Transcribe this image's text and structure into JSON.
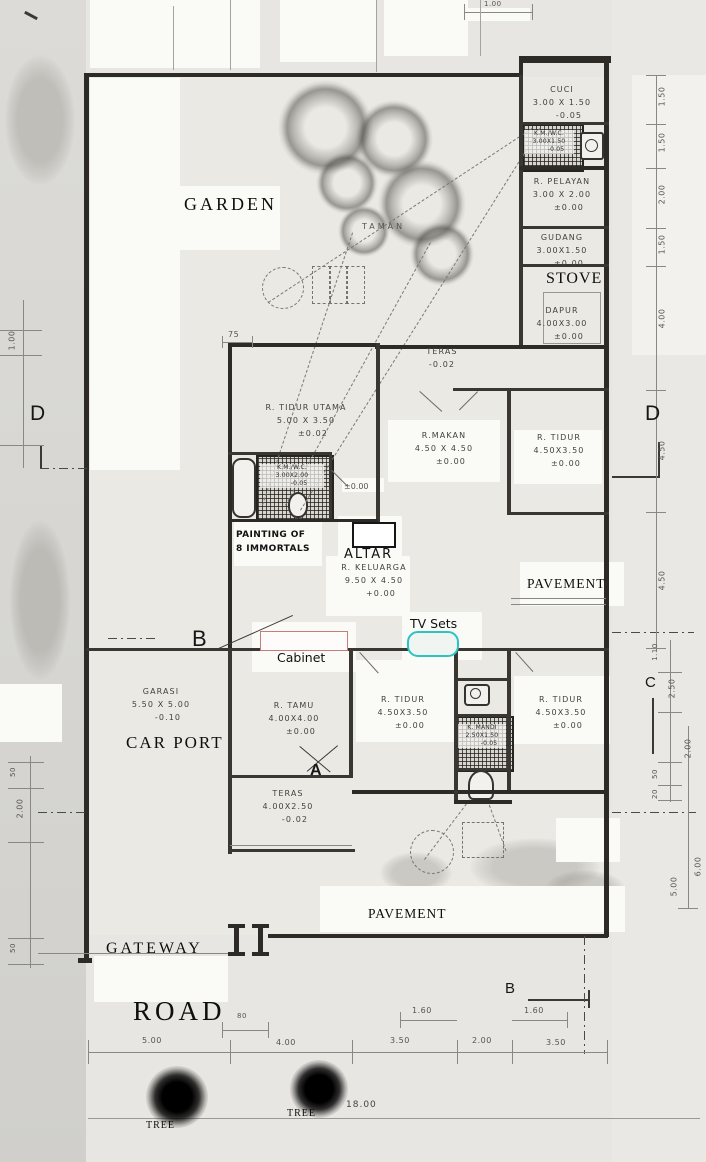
{
  "title": "Scanned house floor plan with annotations",
  "rooms": [
    {
      "name": "CUCI",
      "size": "3.00 X 1.50",
      "level": "-0.05"
    },
    {
      "name": "K.M./W.C.",
      "size": "3.00X1.50",
      "level": "-0.05"
    },
    {
      "name": "R. PELAYAN",
      "size": "3.00 X 2.00",
      "level": "±0.00"
    },
    {
      "name": "GUDANG",
      "size": "3.00X1.50",
      "level": "±0.00"
    },
    {
      "name": "DAPUR",
      "size": "4.00X3.00",
      "level": "±0.00"
    },
    {
      "name": "TERAS",
      "size": "",
      "level": "-0.02"
    },
    {
      "name": "R. TIDUR UTAMA",
      "size": "5.00 X 3.50",
      "level": "±0.02"
    },
    {
      "name": "R.MAKAN",
      "size": "4.50 X 4.50",
      "level": "±0.00"
    },
    {
      "name": "R. TIDUR",
      "size": "4.50X3.50",
      "level": "±0.00"
    },
    {
      "name": "R. KELUARGA",
      "size": "9.50 X 4.50",
      "level": "+0.00"
    },
    {
      "name": "K.M./W.C.",
      "size": "3.00X2.00",
      "level": "-0.05"
    },
    {
      "name": "GARASI",
      "size": "5.50 X 5.00",
      "level": "-0.10"
    },
    {
      "name": "R. TAMU",
      "size": "4.00X4.00",
      "level": "±0.00"
    },
    {
      "name": "R. TIDUR",
      "size": "4.50X3.50",
      "level": "±0.00"
    },
    {
      "name": "K. MANDI",
      "size": "2.50X1.50",
      "level": "-0.05"
    },
    {
      "name": "R. TIDUR",
      "size": "4.50X3.50",
      "level": "±0.00"
    },
    {
      "name": "TERAS",
      "size": "4.00X2.50",
      "level": "-0.02"
    }
  ],
  "annotations": {
    "garden": "GARDEN",
    "taman": "TAMAN",
    "stove": "STOVE",
    "altar": "ALTAR",
    "altar_level": "±0.00",
    "painting1": "PAINTING OF",
    "painting2": "8 IMMORTALS",
    "tv": "TV Sets",
    "cabinet": "Cabinet",
    "car_port": "CAR PORT",
    "pavement_right": "PAVEMENT",
    "pavement_bottom": "PAVEMENT",
    "gateway": "GATEWAY",
    "road": "ROAD",
    "tree": "TREE",
    "tree2": "TREE",
    "road_length": "18.00"
  },
  "markers": {
    "a": "A",
    "b_top": "B",
    "b_bottom": "B",
    "c": "C",
    "d_left": "D",
    "d_right": "D"
  },
  "dims": {
    "right": [
      "1.50",
      "1.50",
      "2.00",
      "1.50",
      "4.00",
      "4.50",
      "4.50",
      "1.10",
      "2.50",
      "2.00",
      "50",
      "20",
      "6.00",
      "5.00"
    ],
    "left": [
      "1.00",
      "75",
      "50",
      "2.00",
      "50"
    ],
    "bottom": [
      "5.00",
      "4.00",
      "3.50",
      "2.00",
      "3.50"
    ],
    "bottom_sub": [
      "80",
      "1.60",
      "1.60"
    ],
    "top": [
      "1.00"
    ]
  },
  "colors": {
    "cabinet_outline": "#c87b7b",
    "tv_outline": "#2bc4c4",
    "wall": "#2e2b27"
  }
}
